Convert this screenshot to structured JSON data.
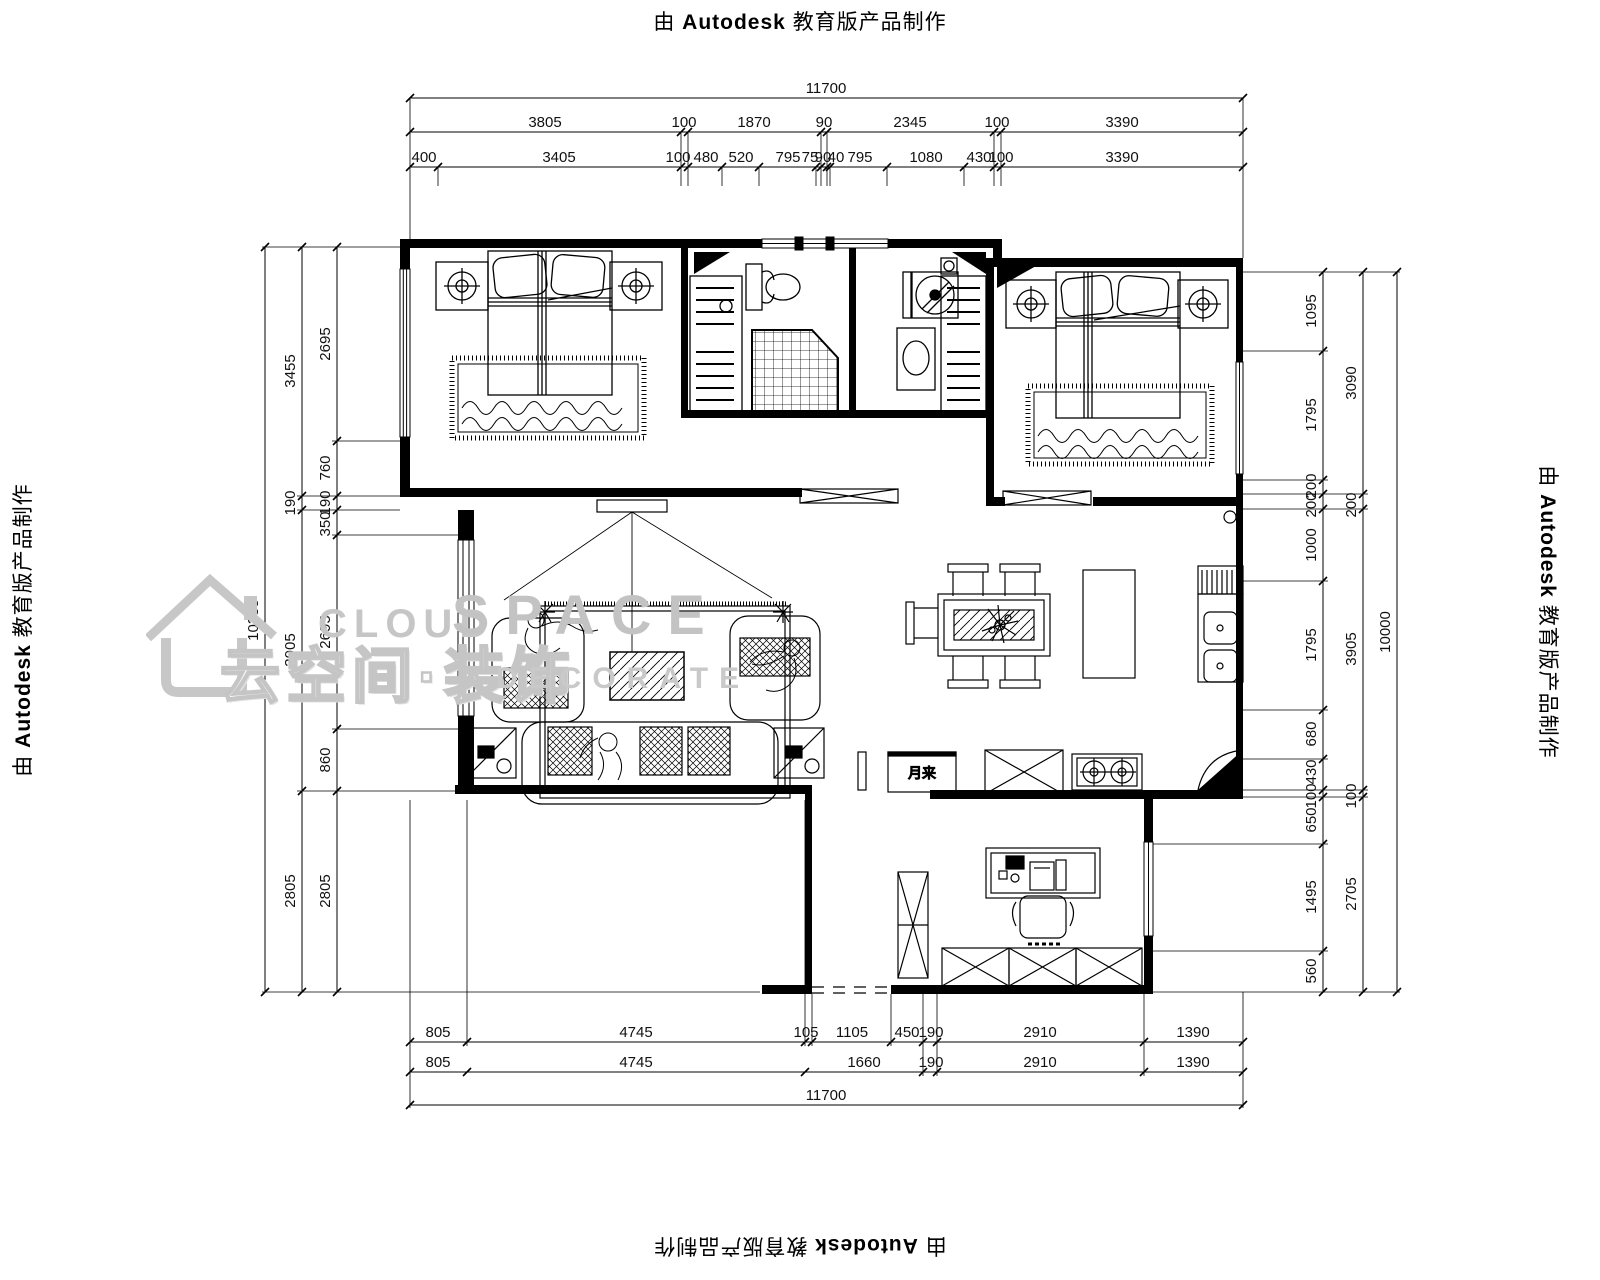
{
  "stamp": {
    "prefix": "由",
    "brand": "Autodesk",
    "suffix": "教育版产品制作"
  },
  "watermark": {
    "word1": "CLOUD",
    "word2": "SPACE",
    "line2_cn": "云空间·装饰",
    "line2_en": "DECORATE"
  },
  "plan_labels": {
    "kitchen_cabinet": "月来"
  },
  "dims": {
    "top": {
      "overall": "11700",
      "row2": [
        "3805",
        "100",
        "1870",
        "90",
        "2345",
        "100",
        "3390"
      ],
      "row3": [
        "400",
        "3405",
        "100",
        "480",
        "520",
        "795",
        "75",
        "90",
        "40",
        "795",
        "1080",
        "430",
        "100",
        "3390"
      ]
    },
    "bottom": {
      "row1": [
        "805",
        "4745",
        "105",
        "1105",
        "450",
        "190",
        "2910",
        "1390"
      ],
      "row2": [
        "805",
        "4745",
        "1660",
        "190",
        "2910",
        "1390"
      ],
      "overall": "11700"
    },
    "left": {
      "overall": "10355",
      "mid": [
        "3455",
        "190",
        "3905",
        "2805"
      ],
      "inner": [
        "2695",
        "760",
        "190",
        "350",
        "2695",
        "860",
        "2805"
      ]
    },
    "right": {
      "inner": [
        "1095",
        "1795",
        "200",
        "200",
        "1000",
        "1795",
        "680",
        "430",
        "100",
        "650",
        "1495",
        "560"
      ],
      "mid": [
        "3090",
        "200",
        "3905",
        "100",
        "2705"
      ],
      "overall": "10000"
    }
  }
}
